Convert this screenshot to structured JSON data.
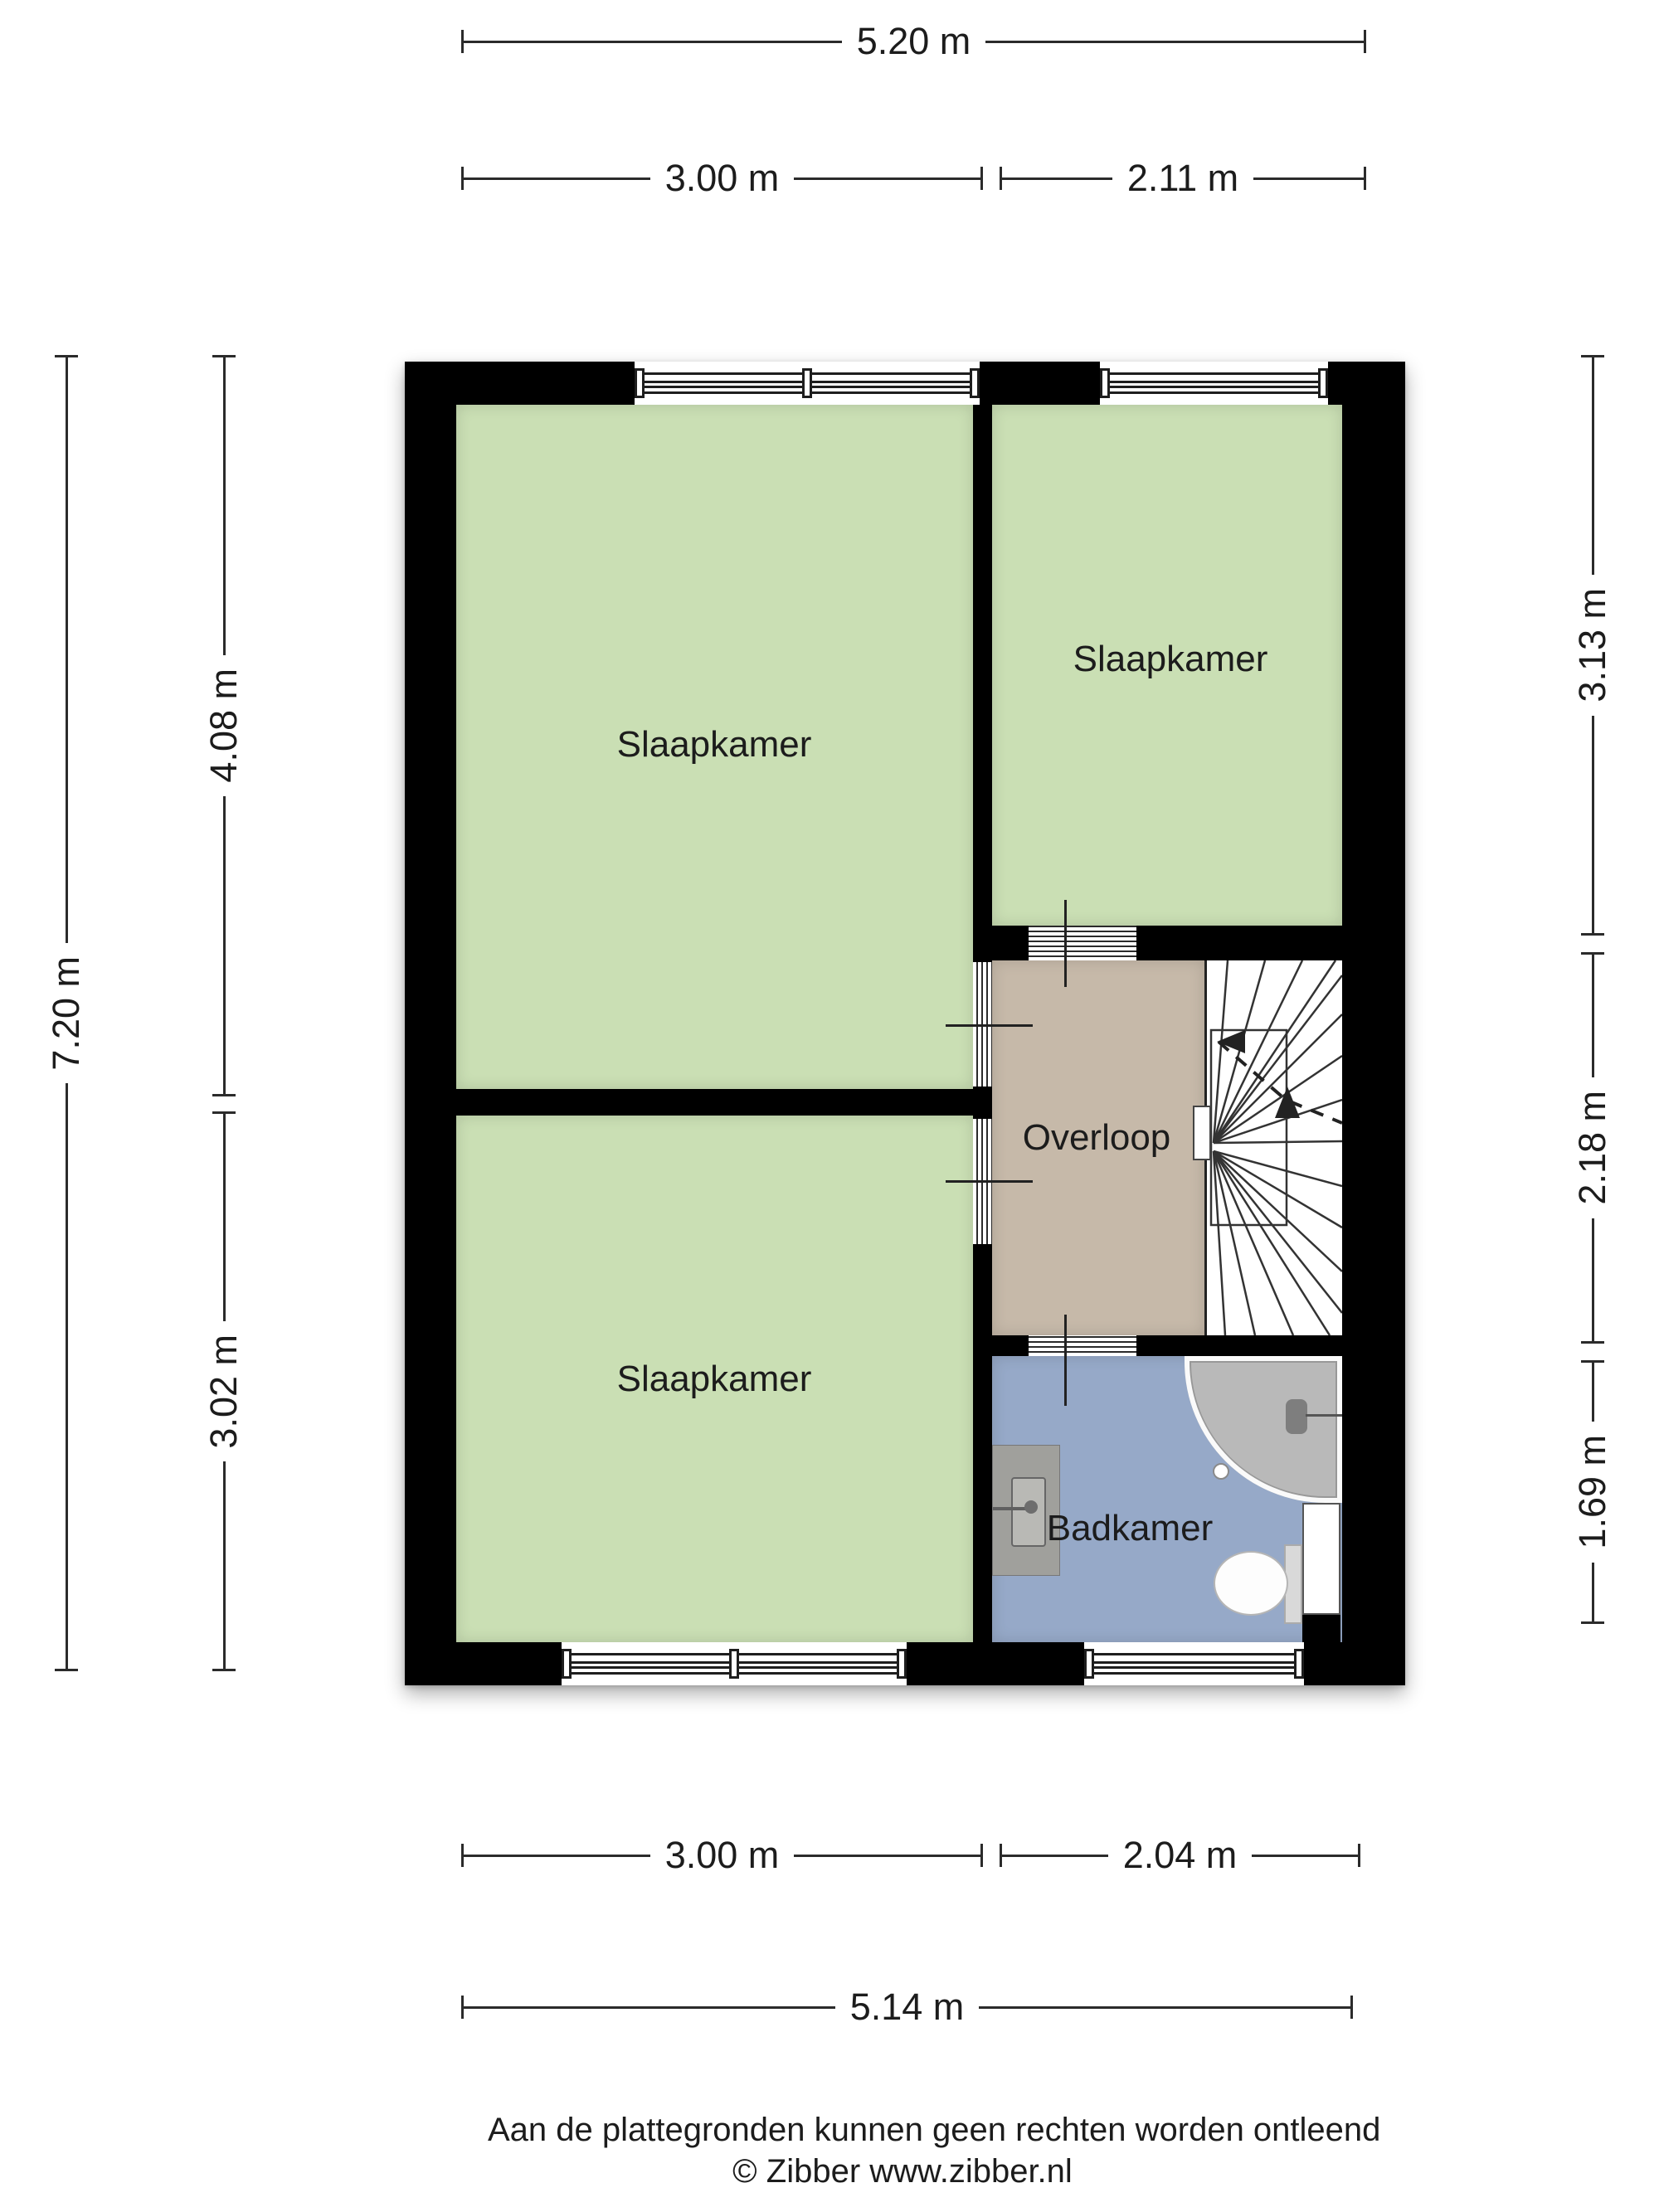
{
  "colors": {
    "wall": "#000000",
    "line": "#2b2b2b",
    "text": "#1c1c1c",
    "room_green": "#cadfb4",
    "hall_tan": "#c6b9a9",
    "bath_blue": "#96a9c8",
    "fixture_gray": "#b9b9b9",
    "vanity_gray": "#a0a09c",
    "tank_gray": "#d9d9d9"
  },
  "rooms": {
    "bedroom_top_left": "Slaapkamer",
    "bedroom_top_right": "Slaapkamer",
    "bedroom_bottom_left": "Slaapkamer",
    "landing": "Overloop",
    "bathroom": "Badkamer"
  },
  "dimensions": {
    "top_total": "5.20 m",
    "top_left": "3.00 m",
    "top_right": "2.11 m",
    "left_total": "7.20 m",
    "left_upper": "4.08 m",
    "left_lower": "3.02 m",
    "right_upper": "3.13 m",
    "right_middle": "2.18 m",
    "right_lower": "1.69 m",
    "bottom_left": "3.00 m",
    "bottom_right": "2.04 m",
    "bottom_total": "5.14 m"
  },
  "footer": {
    "disclaimer": "Aan de plattegronden kunnen geen rechten worden ontleend",
    "copyright": "© Zibber www.zibber.nl"
  }
}
